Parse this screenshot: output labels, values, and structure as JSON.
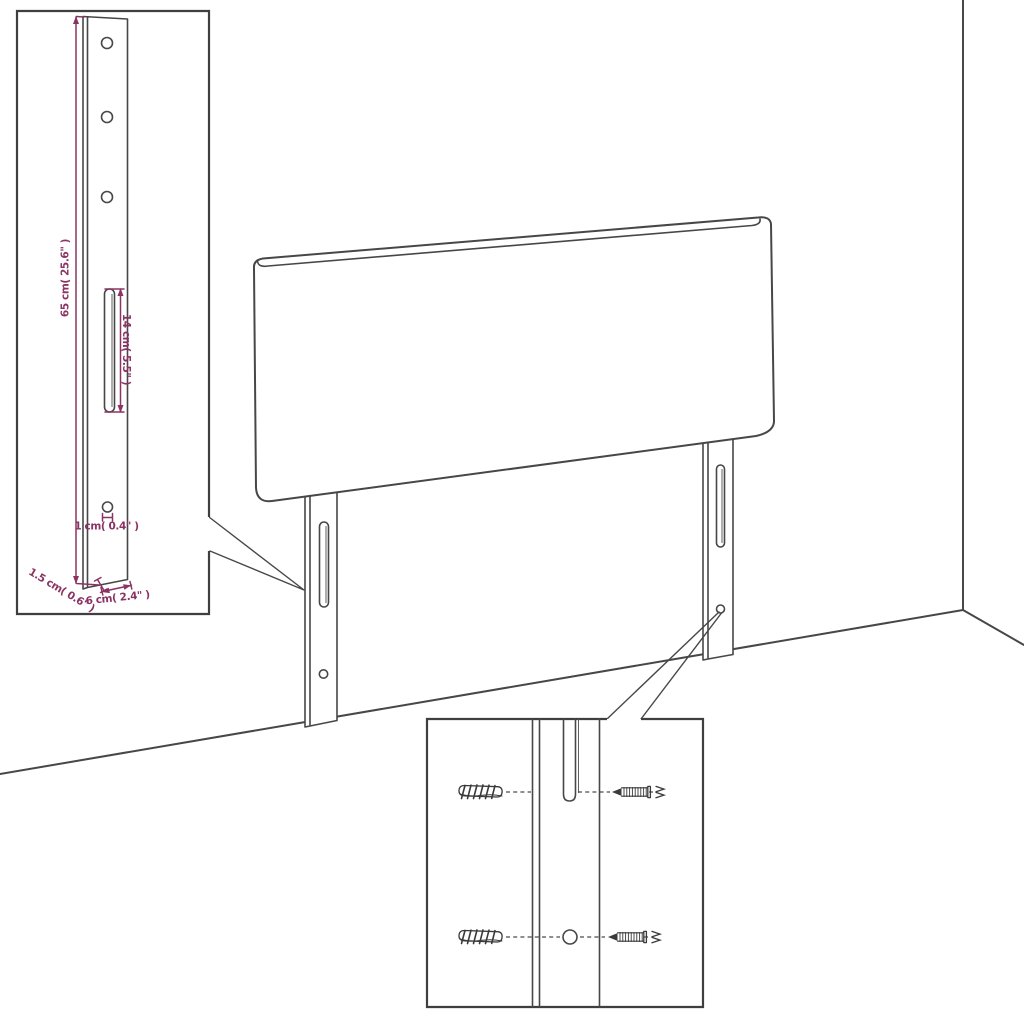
{
  "colors": {
    "background": "#ffffff",
    "outline": "#474747",
    "dimension": "#8b3463"
  },
  "leg_detail_inset": {
    "labels": {
      "height": "65 cm( 25.6\" )",
      "slot_height": "14 cm( 5.5\" )",
      "hole_diameter": "1 cm( 0.4\" )",
      "thickness": "1.5 cm( 0.6\" )",
      "width": "6 cm( 2.4\" )"
    }
  }
}
